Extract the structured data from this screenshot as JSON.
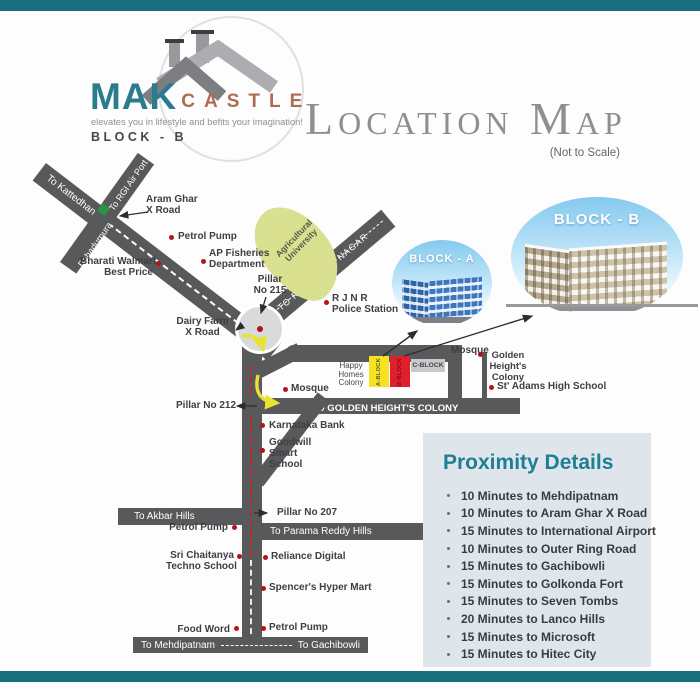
{
  "colors": {
    "teal_bar": "#1a6f7f",
    "accent_teal": "#1f7f92",
    "logo_teal": "#2a7b8d",
    "logo_rust": "#b06a50",
    "road_gray": "#58595b",
    "marker_red": "#b5121b",
    "block_a_yellow": "#f6e223",
    "block_b_red": "#e01f2d",
    "route_red": "#c2242b",
    "agri_green": "#d9e08f"
  },
  "branding": {
    "mak": "MAK",
    "castle": "CASTLE",
    "tagline": "elevates you in lifestyle and befits your imagination!",
    "block": "BLOCK - B"
  },
  "header": {
    "title": "Location Map",
    "subtitle": "(Not to Scale)"
  },
  "map": {
    "roads": {
      "kattedhan": "To Kattedhan",
      "rgi_airport": "To RGI Air Port",
      "bahadurpura": "Bahadurpura",
      "rajender_nagar": "TO RAJENDER NAGAR",
      "golden_heights": "TO GOLDEN HEIGHT'S COLONY",
      "akbar_hills": "To Akbar Hills",
      "parama_reddy": "To Parama Reddy Hills",
      "mehdipatnam": "To Mehdipatnam",
      "gachibowli": "To Gachibowli"
    },
    "areas": {
      "agricultural": [
        "Agricultural",
        "University"
      ],
      "happy_homes": [
        "Happy",
        "Homes",
        "Colony"
      ],
      "golden_colony": [
        "Golden",
        "Height's",
        "Colony"
      ]
    },
    "pois": {
      "aram_ghar": [
        "Aram Ghar",
        "X Road"
      ],
      "petrol_pump_top": "Petrol Pump",
      "ap_fisheries": [
        "AP Fisheries",
        "Department"
      ],
      "bharati_walmart": [
        "Bharati Walmart",
        "Best Price"
      ],
      "pillar_215": [
        "Pillar",
        "No 215"
      ],
      "rjnr": [
        "R J N R",
        "Police Station"
      ],
      "dairy_farm": [
        "Dairy Farm",
        "X Road"
      ],
      "mosque_left": "Mosque",
      "mosque_right": "Mosque",
      "st_adams": "St' Adams High School",
      "pillar_212": "Pillar No 212",
      "karnataka_bank": "Karnataka Bank",
      "goodwill": [
        "Goodwill",
        "Smart",
        "School"
      ],
      "pillar_207": "Pillar No 207",
      "petrol_pump_mid": "Petrol Pump",
      "sri_chaitanya": [
        "Sri Chaitanya",
        "Techno School"
      ],
      "reliance": "Reliance Digital",
      "spencers": "Spencer's Hyper Mart",
      "food_word": "Food Word",
      "petrol_pump_bottom": "Petrol Pump"
    },
    "blocks": {
      "a": "A-BLOCK",
      "b": "B-BLOCK",
      "c": "C-BLOCK"
    }
  },
  "insets": {
    "a_label": "BLOCK - A",
    "b_label": "BLOCK - B"
  },
  "proximity": {
    "title": "Proximity Details",
    "items": [
      "10 Minutes to Mehdipatnam",
      "10 Minutes to Aram Ghar X Road",
      "15 Minutes to International Airport",
      "10 Minutes to Outer Ring Road",
      "15 Minutes to Gachibowli",
      "15 Minutes to Golkonda Fort",
      "15 Minutes to Seven Tombs",
      "20 Minutes to Lanco Hills",
      "15 Minutes to Microsoft",
      "15 Minutes to Hitec City"
    ]
  }
}
